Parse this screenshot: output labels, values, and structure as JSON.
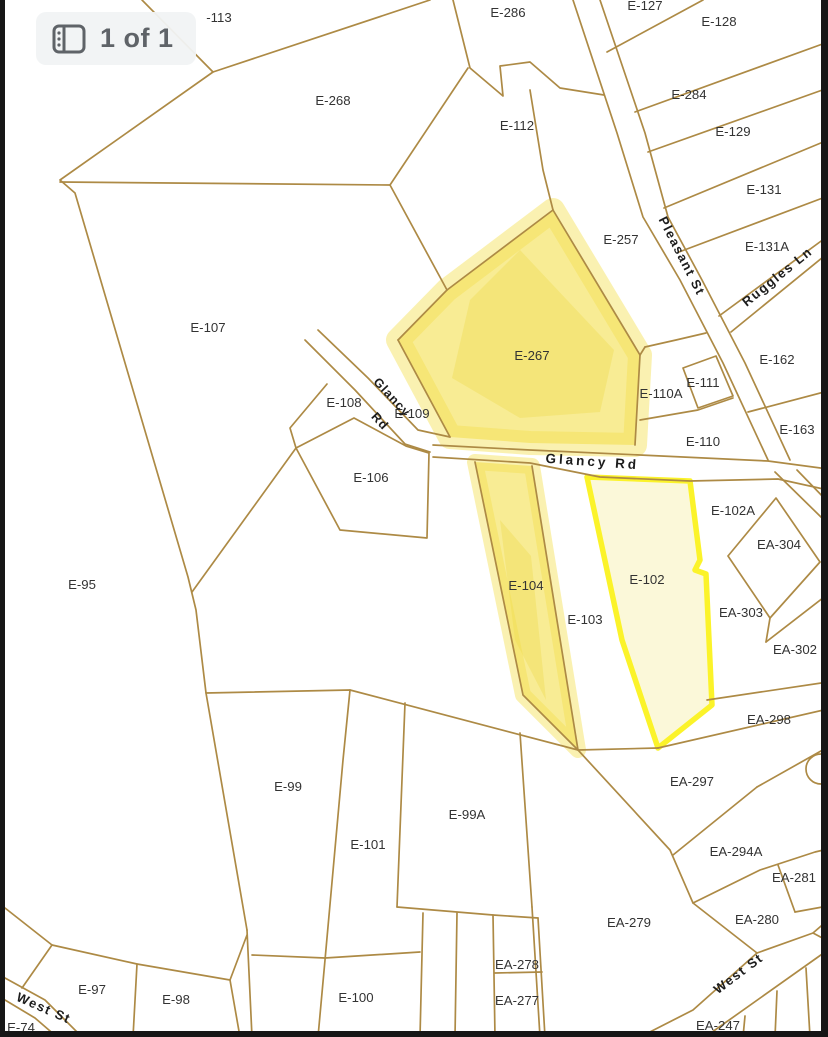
{
  "page_indicator": {
    "text": "1 of 1",
    "icon": "page-thumbnails-icon"
  },
  "map": {
    "background": "#ffffff",
    "line_color": "#ad8a45",
    "label_color": "#333333",
    "road_label_color": "#1c1c1c",
    "edge_color": "#161616",
    "highlight_marker_color": "#f4e052",
    "selected_stroke": "#fbf32a",
    "selected_fill": "#fbf8d9",
    "parcel_labels": [
      {
        "t": "-113",
        "x": 219,
        "y": 22
      },
      {
        "t": "E-286",
        "x": 508,
        "y": 17
      },
      {
        "t": "E-127",
        "x": 645,
        "y": 10
      },
      {
        "t": "E-128",
        "x": 719,
        "y": 26
      },
      {
        "t": "E-268",
        "x": 333,
        "y": 105
      },
      {
        "t": "E-284",
        "x": 689,
        "y": 99
      },
      {
        "t": "E-112",
        "x": 517,
        "y": 130
      },
      {
        "t": "E-129",
        "x": 733,
        "y": 136
      },
      {
        "t": "E-131",
        "x": 764,
        "y": 194
      },
      {
        "t": "E-257",
        "x": 621,
        "y": 244
      },
      {
        "t": "E-131A",
        "x": 767,
        "y": 251
      },
      {
        "t": "E-107",
        "x": 208,
        "y": 332
      },
      {
        "t": "E-267",
        "x": 532,
        "y": 360
      },
      {
        "t": "E-162",
        "x": 777,
        "y": 364
      },
      {
        "t": "E-111",
        "x": 703,
        "y": 387
      },
      {
        "t": "E-110A",
        "x": 661,
        "y": 398
      },
      {
        "t": "E-108",
        "x": 344,
        "y": 407
      },
      {
        "t": "E-109",
        "x": 412,
        "y": 418
      },
      {
        "t": "E-163",
        "x": 797,
        "y": 434
      },
      {
        "t": "E-110",
        "x": 703,
        "y": 446
      },
      {
        "t": "E-106",
        "x": 371,
        "y": 482
      },
      {
        "t": "E-102A",
        "x": 733,
        "y": 515
      },
      {
        "t": "EA-304",
        "x": 779,
        "y": 549
      },
      {
        "t": "E-95",
        "x": 82,
        "y": 589
      },
      {
        "t": "E-102",
        "x": 647,
        "y": 584
      },
      {
        "t": "E-104",
        "x": 526,
        "y": 590
      },
      {
        "t": "EA-303",
        "x": 741,
        "y": 617
      },
      {
        "t": "E-103",
        "x": 585,
        "y": 624
      },
      {
        "t": "EA-302",
        "x": 795,
        "y": 654
      },
      {
        "t": "EA-298",
        "x": 769,
        "y": 724
      },
      {
        "t": "EA-297",
        "x": 692,
        "y": 786
      },
      {
        "t": "E-99",
        "x": 288,
        "y": 791
      },
      {
        "t": "E-99A",
        "x": 467,
        "y": 819
      },
      {
        "t": "E-101",
        "x": 368,
        "y": 849
      },
      {
        "t": "EA-294A",
        "x": 736,
        "y": 856
      },
      {
        "t": "EA-281",
        "x": 794,
        "y": 882
      },
      {
        "t": "EA-280",
        "x": 757,
        "y": 924
      },
      {
        "t": "EA-279",
        "x": 629,
        "y": 927
      },
      {
        "t": "EA-278",
        "x": 517,
        "y": 969
      },
      {
        "t": "E-97",
        "x": 92,
        "y": 994
      },
      {
        "t": "E-98",
        "x": 176,
        "y": 1004
      },
      {
        "t": "E-100",
        "x": 356,
        "y": 1002
      },
      {
        "t": "EA-277",
        "x": 517,
        "y": 1005
      },
      {
        "t": "EA-247",
        "x": 718,
        "y": 1030
      },
      {
        "t": "E-74",
        "x": 21,
        "y": 1032
      }
    ],
    "road_labels": [
      {
        "t": "Pleasant St",
        "x": 678,
        "y": 258,
        "r": 63,
        "ls": 1.5,
        "fs": 13
      },
      {
        "t": "Ruggles Ln",
        "x": 780,
        "y": 280,
        "r": -39,
        "ls": 1.5,
        "fs": 13
      },
      {
        "t": "Glancy Rd",
        "x": 592,
        "y": 466,
        "r": 4,
        "ls": 3,
        "fs": 13.5
      },
      {
        "t": "Glancy",
        "x": 389,
        "y": 400,
        "r": 47,
        "ls": 1,
        "fs": 12.5
      },
      {
        "t": "Rd",
        "x": 377,
        "y": 424,
        "r": 47,
        "ls": 1,
        "fs": 12.5
      },
      {
        "t": "West St",
        "x": 741,
        "y": 977,
        "r": -37,
        "ls": 1.5,
        "fs": 13
      },
      {
        "t": "West St",
        "x": 42,
        "y": 1012,
        "r": 24,
        "ls": 1.5,
        "fs": 13
      }
    ],
    "boundaries": [
      "142,0 213,72 60,180 75,193 188,577 196,610 206,693 350,690 578,750",
      "430,0 213,72",
      "60,182 390,185",
      "453,0 470,68 503,96 500,66 530,62 560,88 604,95",
      "468,68 390,185",
      "390,185 447,290",
      "530,90 543,170 553,210",
      "553,210 447,290 398,340",
      "398,340 450,437",
      "305,340 355,390 405,444 430,452",
      "318,330 368,378 418,430 450,437",
      "433,445 530,450 640,455 768,461 828,469",
      "433,457 530,463 600,477 690,481 778,479 828,490",
      "573,0 617,133 643,217 680,280 723,363 768,460",
      "775,472 823,519",
      "600,0 645,133 668,217 702,280 745,363 790,460",
      "797,470 828,502",
      "607,52 703,0",
      "635,112 828,42",
      "648,152 828,88",
      "664,208 828,140",
      "679,252 828,196",
      "719,316 828,236",
      "731,332 828,253",
      "748,412 828,391",
      "640,420 698,410 733,398",
      "645,347 676,340 706,333",
      "683,368 716,356 733,396 698,408 683,368",
      "553,210 640,355 635,445",
      "640,355 645,347",
      "296,448 354,418 406,446 429,453 427,538 340,530 296,448",
      "327,384 290,428 296,448",
      "296,448 192,592",
      "475,462 523,695 578,750",
      "532,466 578,750",
      "578,750 670,850 693,903 757,953",
      "350,690 343,760 325,960 318,1037",
      "405,703 397,907",
      "397,907 493,915 538,918",
      "520,733 532,907",
      "532,907 540,1037",
      "423,913 420,1037",
      "457,913 455,1037",
      "493,915 495,1037",
      "538,918 545,1037",
      "495,973 542,972",
      "252,955 325,958 420,952",
      "247,930 252,1037",
      "52,945 137,964 230,980 247,935",
      "137,964 133,1037",
      "230,980 240,1037",
      "52,945 22,988",
      "5,978 45,1000 82,1037",
      "5,1000 35,1018 57,1037",
      "52,945 5,908",
      "828,920 813,933 757,953 693,1010 640,1037",
      "828,950 818,957 708,1035 700,1037",
      "745,1016 743,1037",
      "777,991 775,1037",
      "806,968 810,1037",
      "813,933 828,941",
      "673,855 757,787",
      "757,787 828,747",
      "693,903 760,870 815,852 828,849",
      "778,865 795,912",
      "795,912 828,906",
      "707,700 828,682",
      "658,748 828,709",
      "766,642 828,594",
      "770,618 766,642",
      "728,556 776,498 820,562 770,618 728,556",
      "206,693 247,930",
      "578,750 658,748"
    ],
    "highlight_parcels": [
      {
        "id": "E-267",
        "points": "553,210 447,290 398,340 450,437 530,443 635,445 640,355",
        "blur": 24
      },
      {
        "id": "E-104",
        "points": "475,462 532,466 578,750 523,695",
        "blur": 16
      }
    ],
    "highlight_streaks": [
      {
        "points": "520,250 470,300 452,378 520,418 600,412 614,350"
      },
      {
        "points": "500,520 515,640 546,700 531,556"
      }
    ],
    "selected_parcel": {
      "id": "E-102",
      "points": "587,477 690,481 700,560 695,570 706,574 712,705 658,748 622,640"
    },
    "circles": [
      {
        "cx": 821,
        "cy": 769,
        "r": 15
      }
    ]
  }
}
